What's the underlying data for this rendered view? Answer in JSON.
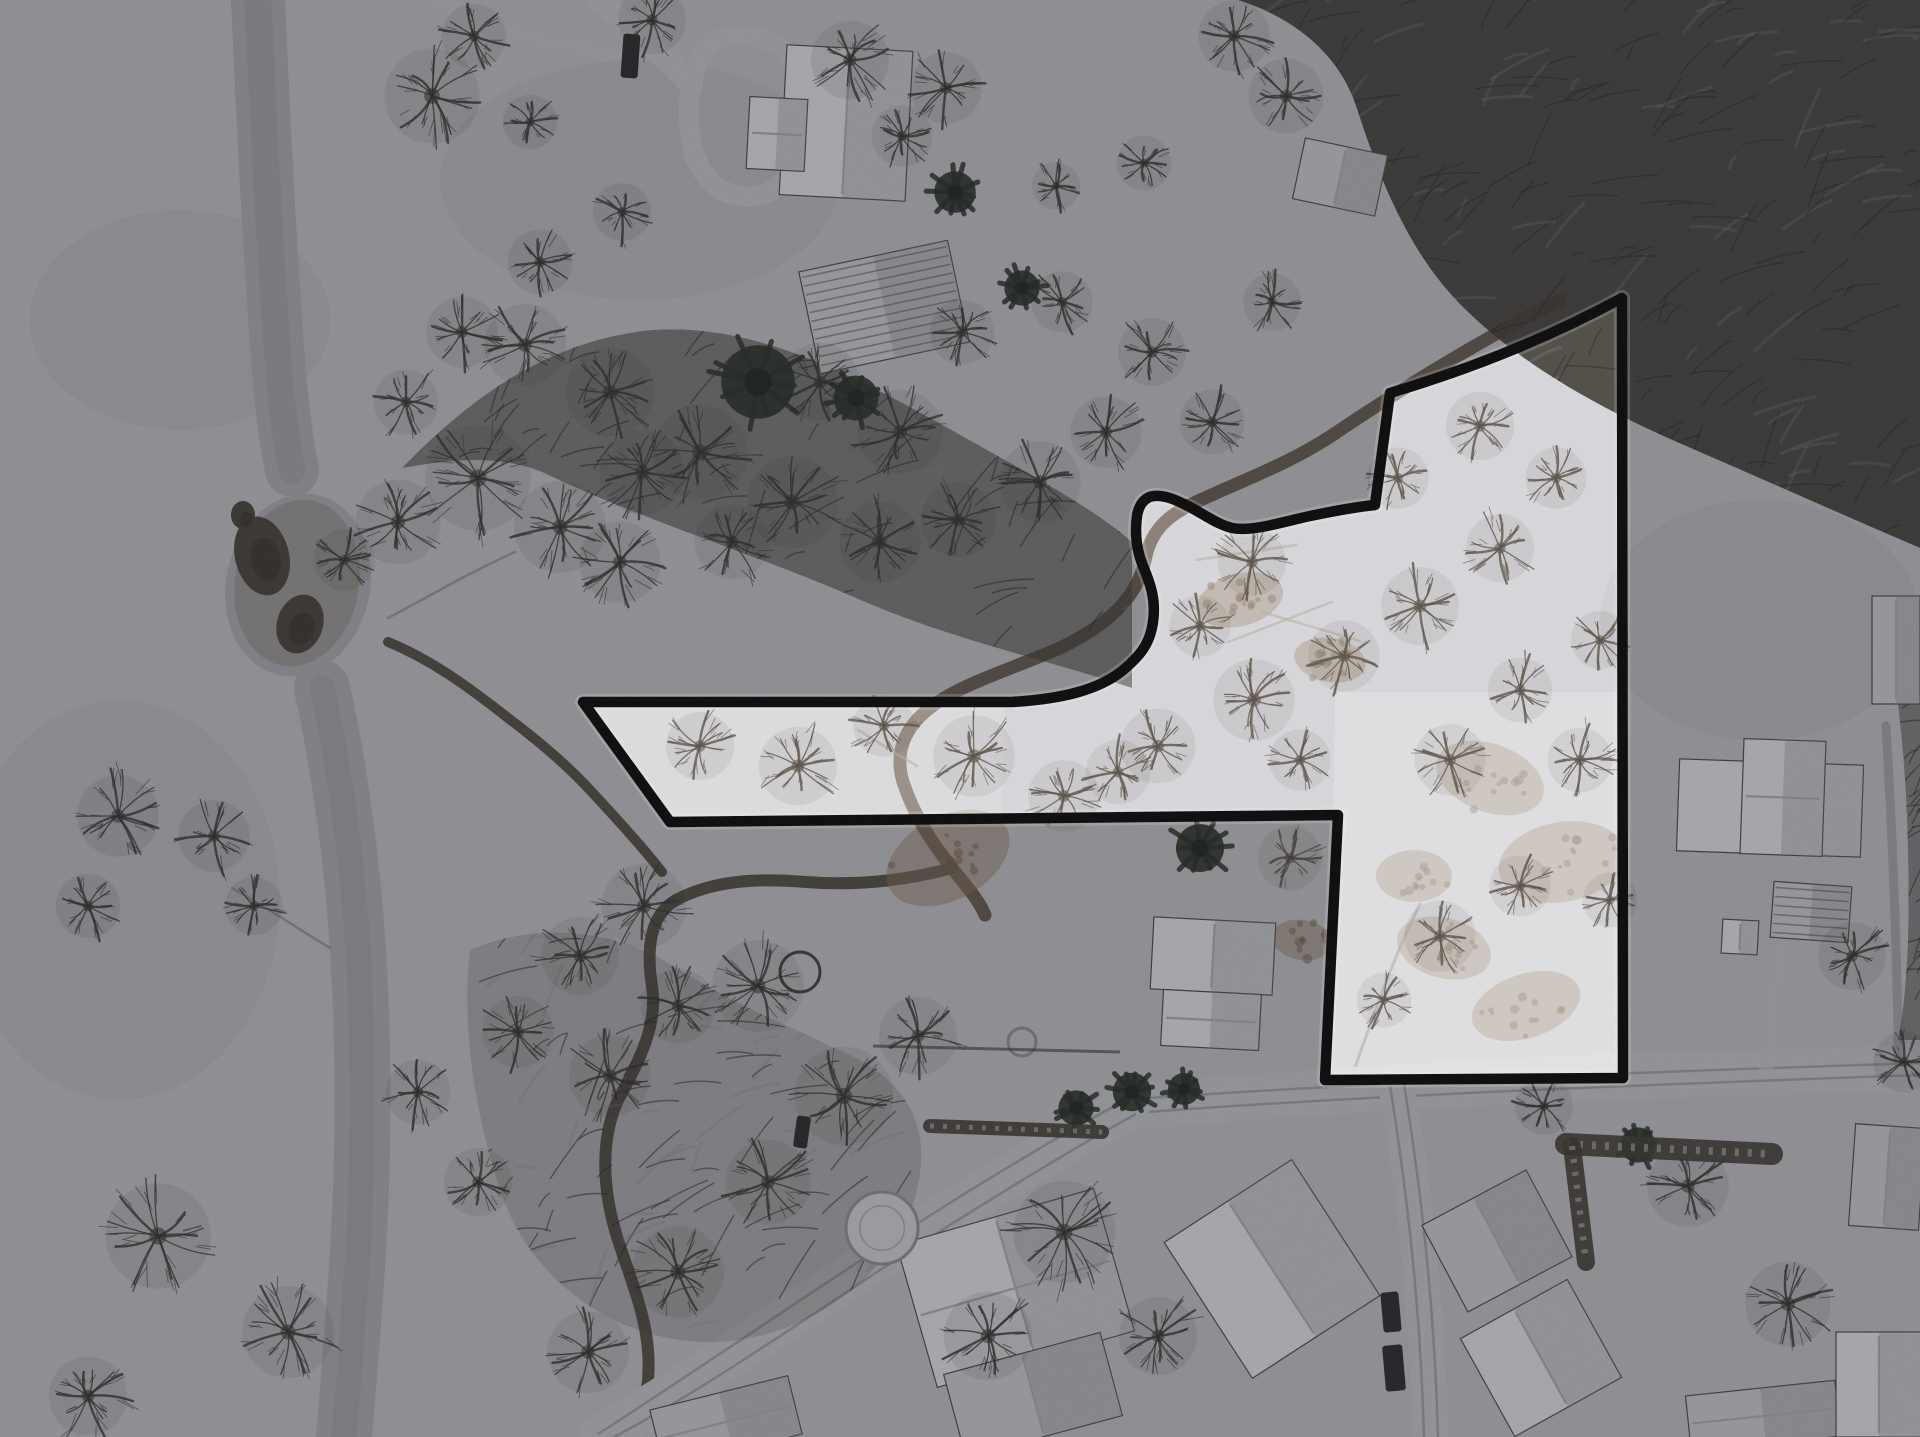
{
  "meta": {
    "width": 1920,
    "height": 1437
  },
  "palette": {
    "snow_base": "#cdced2",
    "dim_overlay": "rgba(18,19,23,0.34)",
    "boundary_stroke": "#0c0c0c",
    "boundary_halo": "rgba(248,249,251,0.18)",
    "river_channel": "#b7b8bc",
    "river_core": "#aaabaf",
    "open_water": "#4e4a42",
    "open_water_dark": "#423e37",
    "mud_ring": "rgba(122,106,88,0.28)",
    "creek": "#5a544b",
    "creek_brown": "#6e6156",
    "forest_fill": "#45423c",
    "forest_texture": "#2f2d29",
    "forest_snow_gap": "#8f9094",
    "tree_dark": "#3b3833",
    "tree_inside": "#5c5248",
    "evergreen": "#2e362e",
    "road_fill": "#d2d3d6",
    "road_track": "#8e8f93",
    "roof_white": "#f0f1f3",
    "roof_light": "#d7d9dc",
    "roof_shade": "rgba(140,143,148,0.30)",
    "roof_edge": "#57544d",
    "ridge_line": "#b6b9bd",
    "rib_line": "rgba(90,88,82,0.55)",
    "dirt_tan": "#9a8166",
    "dirt_brown": "#7c6750",
    "hedge": "#474338",
    "hedge_snow": "#d8dadc",
    "vehicle_dark": "#2f2f31",
    "trail": "rgba(82,84,88,0.35)",
    "log": "#b9b2a6",
    "blotch": "#3c3e44",
    "snow_patch": "#ffffff",
    "ring_gray": "#9a9ca0",
    "ring_dark": "#4a463f",
    "pool_fill": "#dfe1e4"
  },
  "boundary": {
    "path": "M583,702 L1012,702 C1062,699 1098,690 1122,671 C1140,656 1150,644 1153,622 C1156,600 1151,585 1143,566 C1136,549 1135,531 1137,516 C1139,504 1145,497 1154,496 C1164,495 1174,499 1186,505 C1204,514 1216,524 1232,528 C1252,532 1282,522 1310,516 C1334,511 1356,507 1375,505 L1390,393 C1437,379 1524,351 1622,298 L1623,1078 L1325,1080 L1338,815 L670,822 Z",
    "stroke_width": 10.5,
    "halo_width": 16
  },
  "scene": {
    "blotches": [
      {
        "cx": 180,
        "cy": 320,
        "rx": 150,
        "ry": 110,
        "a": 0.05
      },
      {
        "cx": 120,
        "cy": 900,
        "rx": 160,
        "ry": 200,
        "a": 0.04
      },
      {
        "cx": 640,
        "cy": 180,
        "rx": 200,
        "ry": 120,
        "a": 0.04
      },
      {
        "cx": 1760,
        "cy": 620,
        "rx": 160,
        "ry": 120,
        "a": 0.05
      }
    ],
    "river": {
      "upper_path": "M258,0 C262,90 266,180 272,270 C277,350 280,410 292,470",
      "upper_width": 54,
      "blob": {
        "cx": 298,
        "cy": 585,
        "rx": 72,
        "ry": 92,
        "rot": 12
      },
      "mud_ring": {
        "cx": 297,
        "cy": 583,
        "rx": 62,
        "ry": 84,
        "rot": 10
      },
      "lower_path": "M322,688 C340,770 352,860 358,950 C364,1050 364,1150 358,1250 C353,1330 348,1390 344,1437",
      "lower_width": 56,
      "open_water": [
        {
          "cx": 262,
          "cy": 556,
          "rx": 27,
          "ry": 40,
          "rot": -14
        },
        {
          "cx": 300,
          "cy": 624,
          "rx": 23,
          "ry": 30,
          "rot": 18
        },
        {
          "cx": 243,
          "cy": 515,
          "rx": 12,
          "ry": 14,
          "rot": 0
        }
      ]
    },
    "trails": [
      {
        "d": "M388,618 C430,596 470,572 515,552",
        "w": 2.5
      },
      {
        "d": "M232,888 C268,908 300,930 330,948",
        "w": 2.5
      },
      {
        "d": "M1352,1076 C1372,1020 1392,960 1420,904",
        "w": 3
      }
    ],
    "creeks": [
      {
        "d": "M1560,300 C1480,340 1400,390 1340,430 C1290,465 1230,485 1190,505 C1168,516 1152,530 1146,556 C1140,590 1118,620 1060,648 C1014,668 968,682 938,702 C908,722 893,748 903,782 C913,812 928,838 952,868 C968,888 980,902 985,915",
        "w": 13,
        "c": "creek_brown"
      },
      {
        "d": "M952,868 C908,880 858,886 806,882 C758,878 714,880 676,900 C650,915 646,948 652,986 C658,1024 640,1060 618,1100 C600,1140 602,1190 618,1240 C636,1295 652,1330 648,1380 C645,1410 638,1425 632,1437",
        "w": 12,
        "c": "creek"
      },
      {
        "d": "M388,642 C432,660 470,688 508,718 C540,742 566,764 590,790 C614,816 640,844 662,872",
        "w": 10,
        "c": "creek"
      }
    ],
    "roads": [
      {
        "d": "M1120,1108 C1300,1092 1500,1080 1700,1074 C1780,1072 1850,1070 1920,1068",
        "w": 46,
        "tracks": [
          "M1122,1100 C1300,1087 1520,1076 1920,1063",
          "M1122,1114 C1300,1100 1520,1089 1920,1075"
        ]
      },
      {
        "d": "M1128,1108 C1050,1150 950,1210 860,1270 C770,1330 680,1390 600,1437",
        "w": 44,
        "tracks": [
          "M1122,1102 C1040,1146 940,1208 852,1266 C764,1324 676,1384 598,1434",
          "M1136,1114 C1056,1158 956,1220 868,1278 C780,1336 692,1396 614,1437"
        ]
      },
      {
        "d": "M1396,1085 C1408,1150 1418,1230 1424,1310 C1428,1370 1430,1410 1431,1437",
        "w": 36,
        "tracks": [
          "M1390,1086 C1402,1160 1412,1240 1418,1320 C1421,1362 1423,1400 1424,1437",
          "M1404,1084 C1416,1158 1426,1238 1432,1318 C1435,1360 1437,1400 1438,1437"
        ]
      },
      {
        "d": "M712,42 C742,30 772,34 790,58 C808,82 812,118 802,150 C792,182 768,200 740,196 C712,192 694,168 690,134 C686,100 692,62 712,42 Z",
        "w": 20,
        "open": true,
        "tracks": []
      },
      {
        "d": "M598,0 C628,24 660,52 692,86",
        "w": 22,
        "tracks": []
      },
      {
        "d": "M432,0 C470,18 516,34 560,44 C600,53 640,56 678,54",
        "w": 16,
        "a": 0.5,
        "tracks": []
      },
      {
        "d": "M1886,726 C1892,826 1896,926 1898,1026 L1898,1062",
        "w": 9,
        "a": 0.5,
        "c": "road_track",
        "tracks": []
      },
      {
        "d": "M1766,1070 C1772,1020 1778,970 1784,920",
        "w": 14,
        "a": 0.6,
        "tracks": []
      }
    ],
    "dirt_patches": [
      {
        "cx": 1490,
        "cy": 778,
        "rx": 56,
        "ry": 34,
        "rot": 20
      },
      {
        "cx": 1562,
        "cy": 862,
        "rx": 64,
        "ry": 40,
        "rot": -10
      },
      {
        "cx": 1444,
        "cy": 948,
        "rx": 48,
        "ry": 30,
        "rot": 15
      },
      {
        "cx": 1526,
        "cy": 1006,
        "rx": 56,
        "ry": 32,
        "rot": -18
      },
      {
        "cx": 1414,
        "cy": 876,
        "rx": 38,
        "ry": 26,
        "rot": 0
      },
      {
        "cx": 1302,
        "cy": 940,
        "rx": 30,
        "ry": 20,
        "rot": 10
      },
      {
        "cx": 948,
        "cy": 858,
        "rx": 66,
        "ry": 42,
        "rot": -28
      },
      {
        "cx": 1240,
        "cy": 600,
        "rx": 44,
        "ry": 26,
        "rot": -15
      },
      {
        "cx": 1330,
        "cy": 660,
        "rx": 36,
        "ry": 22,
        "rot": 10
      }
    ],
    "inside_patches": [
      {
        "use_boundary": true,
        "alpha": 0.2
      },
      {
        "d": "M1335,692 L1618,692 L1618,1076 L1330,1078 Z",
        "alpha": 0.2
      },
      {
        "d": "M590,706 L1005,706 L1002,818 L676,820 Z",
        "alpha": 0.13
      }
    ],
    "forests": [
      {
        "d": "M1238,0 L1920,0 L1920,548 C1836,512 1760,478 1686,446 C1598,408 1516,362 1458,302 C1408,250 1380,180 1358,112 C1344,64 1306,22 1238,0 Z",
        "tex": 260,
        "alpha": 0.92
      },
      {
        "d": "M402,468 C470,398 548,340 652,330 C756,322 858,378 948,428 C1026,472 1094,508 1132,542 L1132,688 C1040,658 946,638 856,598 C760,556 642,520 542,472 C492,452 440,462 402,468 Z",
        "tex": 210,
        "alpha": 0.55
      },
      {
        "d": "M1896,690 C1906,760 1910,850 1908,940 C1906,990 1902,1020 1898,1040 L1920,1040 L1920,690 Z",
        "tex": 40,
        "alpha": 0.5
      },
      {
        "d": "M470,950 C540,920 620,930 680,970 C740,1008 800,1030 860,1060 C910,1088 930,1130 918,1185 C906,1245 860,1295 800,1322 C738,1350 672,1348 614,1320 C554,1290 516,1242 498,1184 C478,1122 460,1030 470,950 Z",
        "tex": 130,
        "alpha": 0.18
      }
    ],
    "logs": [
      {
        "x1": 1228,
        "y1": 642,
        "x2": 1332,
        "y2": 602
      },
      {
        "x1": 1262,
        "y1": 612,
        "x2": 1360,
        "y2": 641
      },
      {
        "x1": 858,
        "y1": 730,
        "x2": 917,
        "y2": 766
      },
      {
        "x1": 1196,
        "y1": 560,
        "x2": 1296,
        "y2": 545
      }
    ],
    "buildings": [
      {
        "x": 783,
        "y": 48,
        "w": 126,
        "h": 150,
        "rot": 3,
        "fill": "roof_white",
        "type": "v"
      },
      {
        "x": 748,
        "y": 98,
        "w": 58,
        "h": 72,
        "rot": 3,
        "fill": "roof_white",
        "type": "h"
      },
      {
        "x": 808,
        "y": 255,
        "w": 152,
        "h": 104,
        "rot": -12,
        "fill": "roof_light",
        "type": "ribs"
      },
      {
        "x": 1298,
        "y": 146,
        "w": 84,
        "h": 62,
        "rot": 12,
        "fill": "roof_light",
        "type": "v"
      },
      {
        "x": 1872,
        "y": 596,
        "w": 48,
        "h": 108,
        "rot": 0,
        "fill": "roof_light",
        "type": "v"
      },
      {
        "x": 1678,
        "y": 762,
        "w": 184,
        "h": 92,
        "rot": 2,
        "fill": "roof_white",
        "type": "v"
      },
      {
        "x": 1742,
        "y": 740,
        "w": 82,
        "h": 115,
        "rot": 2,
        "fill": "roof_white",
        "type": "h"
      },
      {
        "x": 1772,
        "y": 884,
        "w": 78,
        "h": 56,
        "rot": 4,
        "fill": "roof_light",
        "type": "ribs"
      },
      {
        "x": 1722,
        "y": 920,
        "w": 36,
        "h": 34,
        "rot": 3,
        "fill": "roof_white",
        "type": "v"
      },
      {
        "x": 1152,
        "y": 920,
        "w": 122,
        "h": 72,
        "rot": 3,
        "fill": "roof_white",
        "type": "v"
      },
      {
        "x": 1162,
        "y": 992,
        "w": 98,
        "h": 56,
        "rot": 3,
        "fill": "roof_white",
        "type": "h"
      },
      {
        "x": 1196,
        "y": 1188,
        "w": 152,
        "h": 162,
        "rot": -33,
        "fill": "roof_white",
        "type": "v"
      },
      {
        "x": 1438,
        "y": 1192,
        "w": 118,
        "h": 98,
        "rot": -28,
        "fill": "roof_light",
        "type": "v"
      },
      {
        "x": 1480,
        "y": 1302,
        "w": 122,
        "h": 112,
        "rot": -29,
        "fill": "roof_white",
        "type": "v"
      },
      {
        "x": 913,
        "y": 1214,
        "w": 205,
        "h": 148,
        "rot": -16,
        "fill": "roof_white",
        "type": "cross"
      },
      {
        "x": 952,
        "y": 1352,
        "w": 162,
        "h": 86,
        "rot": -15,
        "fill": "roof_light",
        "type": "v"
      },
      {
        "x": 655,
        "y": 1392,
        "w": 142,
        "h": 60,
        "rot": -14,
        "fill": "roof_light",
        "type": "h"
      },
      {
        "x": 1688,
        "y": 1388,
        "w": 150,
        "h": 56,
        "rot": -6,
        "fill": "roof_light",
        "type": "h"
      },
      {
        "x": 1836,
        "y": 1332,
        "w": 86,
        "h": 105,
        "rot": 0,
        "fill": "roof_white",
        "type": "v"
      },
      {
        "x": 1852,
        "y": 1126,
        "w": 70,
        "h": 102,
        "rot": 4,
        "fill": "roof_light",
        "type": "v"
      }
    ],
    "vehicles": [
      {
        "x": 622,
        "y": 34,
        "w": 17,
        "h": 44,
        "rot": 4
      },
      {
        "x": 1382,
        "y": 1292,
        "w": 18,
        "h": 40,
        "rot": -5
      },
      {
        "x": 1384,
        "y": 1345,
        "w": 20,
        "h": 46,
        "rot": -5
      },
      {
        "x": 795,
        "y": 1116,
        "w": 14,
        "h": 32,
        "rot": 8
      }
    ],
    "rings": [
      {
        "cx": 882,
        "cy": 1228,
        "r": 36,
        "kind": "pool"
      },
      {
        "cx": 800,
        "cy": 972,
        "r": 20,
        "kind": "dark"
      },
      {
        "cx": 1022,
        "cy": 1042,
        "r": 14,
        "kind": "gray"
      }
    ],
    "hedges": [
      {
        "d": "M1566,1144 L1772,1154",
        "w": 22
      },
      {
        "d": "M1572,1146 L1586,1262",
        "w": 18
      },
      {
        "d": "M930,1126 L1102,1132",
        "w": 14
      }
    ],
    "fences": [
      {
        "x1": 873,
        "y1": 1046,
        "x2": 1120,
        "y2": 1052
      }
    ],
    "trees_bare": [
      [
        432,
        96,
        56
      ],
      [
        474,
        36,
        38
      ],
      [
        652,
        20,
        40
      ],
      [
        850,
        60,
        46
      ],
      [
        946,
        88,
        42
      ],
      [
        902,
        136,
        36
      ],
      [
        1056,
        186,
        28
      ],
      [
        1144,
        163,
        32
      ],
      [
        1234,
        36,
        42
      ],
      [
        1286,
        96,
        44
      ],
      [
        525,
        345,
        48
      ],
      [
        610,
        392,
        52
      ],
      [
        700,
        452,
        56
      ],
      [
        792,
        502,
        54
      ],
      [
        880,
        542,
        48
      ],
      [
        958,
        520,
        44
      ],
      [
        1040,
        482,
        48
      ],
      [
        1106,
        432,
        42
      ],
      [
        900,
        432,
        50
      ],
      [
        820,
        382,
        46
      ],
      [
        962,
        332,
        38
      ],
      [
        1062,
        302,
        36
      ],
      [
        1152,
        352,
        40
      ],
      [
        1212,
        422,
        38
      ],
      [
        1272,
        302,
        34
      ],
      [
        642,
        472,
        50
      ],
      [
        732,
        542,
        44
      ],
      [
        398,
        522,
        50
      ],
      [
        478,
        478,
        62
      ],
      [
        560,
        527,
        54
      ],
      [
        344,
        560,
        36
      ],
      [
        620,
        562,
        48
      ],
      [
        214,
        836,
        42
      ],
      [
        118,
        816,
        48
      ],
      [
        88,
        906,
        38
      ],
      [
        254,
        906,
        34
      ],
      [
        644,
        906,
        50
      ],
      [
        580,
        956,
        46
      ],
      [
        518,
        1032,
        42
      ],
      [
        610,
        1076,
        48
      ],
      [
        678,
        1006,
        44
      ],
      [
        758,
        986,
        54
      ],
      [
        844,
        1096,
        58
      ],
      [
        918,
        1036,
        46
      ],
      [
        768,
        1182,
        50
      ],
      [
        678,
        1272,
        54
      ],
      [
        588,
        1352,
        48
      ],
      [
        478,
        1182,
        40
      ],
      [
        418,
        1092,
        38
      ],
      [
        158,
        1236,
        62
      ],
      [
        288,
        1332,
        54
      ],
      [
        88,
        1396,
        46
      ],
      [
        988,
        1336,
        52
      ],
      [
        1064,
        1232,
        60
      ],
      [
        1158,
        1336,
        46
      ],
      [
        1688,
        1186,
        48
      ],
      [
        1788,
        1304,
        50
      ],
      [
        1852,
        956,
        40
      ],
      [
        1904,
        1062,
        36
      ],
      [
        1544,
        1106,
        34
      ],
      [
        530,
        122,
        32
      ],
      [
        622,
        212,
        34
      ],
      [
        540,
        262,
        38
      ],
      [
        462,
        332,
        42
      ],
      [
        406,
        402,
        38
      ]
    ],
    "trees_inside": [
      [
        700,
        746,
        40
      ],
      [
        798,
        766,
        46
      ],
      [
        884,
        726,
        36
      ],
      [
        974,
        756,
        48
      ],
      [
        1064,
        796,
        42
      ],
      [
        1158,
        746,
        44
      ],
      [
        1254,
        700,
        48
      ],
      [
        1344,
        656,
        42
      ],
      [
        1300,
        760,
        36
      ],
      [
        1420,
        606,
        46
      ],
      [
        1500,
        548,
        40
      ],
      [
        1556,
        478,
        36
      ],
      [
        1480,
        426,
        40
      ],
      [
        1398,
        478,
        36
      ],
      [
        1252,
        562,
        40
      ],
      [
        1200,
        626,
        36
      ],
      [
        1118,
        772,
        38
      ],
      [
        1290,
        858,
        38
      ],
      [
        1440,
        936,
        42
      ],
      [
        1520,
        886,
        36
      ],
      [
        1384,
        1000,
        32
      ],
      [
        1600,
        640,
        34
      ],
      [
        1580,
        760,
        38
      ],
      [
        1610,
        900,
        32
      ],
      [
        1450,
        760,
        42
      ],
      [
        1520,
        690,
        38
      ]
    ],
    "evergreens": [
      [
        758,
        382,
        46
      ],
      [
        856,
        398,
        28
      ],
      [
        1022,
        288,
        22
      ],
      [
        955,
        192,
        26
      ],
      [
        1132,
        1092,
        24
      ],
      [
        1184,
        1089,
        20
      ],
      [
        1076,
        1108,
        22
      ],
      [
        1638,
        1145,
        22
      ],
      [
        1200,
        848,
        30
      ]
    ]
  }
}
